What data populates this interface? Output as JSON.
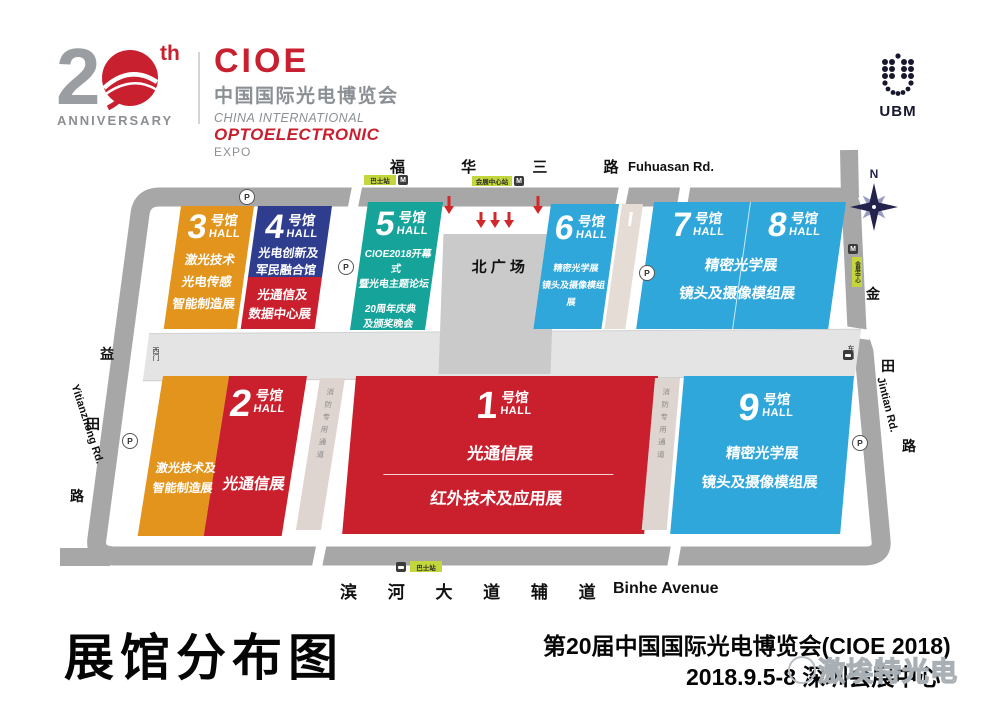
{
  "header": {
    "anniversary": {
      "number": "20",
      "suffix": "th",
      "label": "ANNIVERSARY"
    },
    "cioe": {
      "wordmark": "CIOE",
      "cn": "中国国际光电博览会",
      "en1": "CHINA INTERNATIONAL",
      "en2": "OPTOELECTRONIC",
      "en3": "EXPO"
    },
    "ubm": "UBM"
  },
  "map": {
    "compass_n": "N",
    "plaza": "北 广 场",
    "fire_lane": "消防专用通道",
    "gates": {
      "west": "西门",
      "east": "东门"
    },
    "roads": {
      "top_cn": "福 华 三 路",
      "top_en": "Fuhuasan Rd.",
      "left_cn": [
        "益",
        "田",
        "路"
      ],
      "left_en": "Yitianzhong Rd.",
      "right_cn": [
        "金",
        "田",
        "路"
      ],
      "right_en": "Jintian Rd.",
      "bottom_cn": "滨 河 大 道 辅 道",
      "bottom_en": "Binhe Avenue"
    },
    "badges": {
      "parking": "P",
      "metro": "M",
      "top_bus": "巴士站",
      "top_metro_station": "会展中心站",
      "right_station": "会展中心",
      "bottom_bus": "巴士站"
    },
    "halls": {
      "h3": {
        "num": "3",
        "cn": "号馆",
        "en": "HALL",
        "lines": [
          "激光技术",
          "光电传感",
          "智能制造展"
        ]
      },
      "h4": {
        "num": "4",
        "cn": "号馆",
        "en": "HALL",
        "top_lines": [
          "光电创新及",
          "军民融合馆"
        ],
        "bottom_lines": [
          "光通信及",
          "数据中心展"
        ]
      },
      "h5": {
        "num": "5",
        "cn": "号馆",
        "en": "HALL",
        "lines1": [
          "CIOE2018开幕式",
          "暨光电主题论坛"
        ],
        "lines2": [
          "20周年庆典",
          "及颁奖晚会"
        ]
      },
      "h6": {
        "num": "6",
        "cn": "号馆",
        "en": "HALL",
        "lines": [
          "精密光学展",
          "镜头及摄像模组展"
        ]
      },
      "h7": {
        "num": "7",
        "cn": "号馆",
        "en": "HALL"
      },
      "h8": {
        "num": "8",
        "cn": "号馆",
        "en": "HALL"
      },
      "h78_lines": [
        "精密光学展",
        "镜头及摄像模组展"
      ],
      "h2": {
        "num": "2",
        "cn": "号馆",
        "en": "HALL",
        "left_lines": [
          "激光技术及",
          "智能制造展"
        ],
        "right_line": "光通信展"
      },
      "h1": {
        "num": "1",
        "cn": "号馆",
        "en": "HALL",
        "line1": "光通信展",
        "line2": "红外技术及应用展"
      },
      "h9": {
        "num": "9",
        "cn": "号馆",
        "en": "HALL",
        "lines": [
          "精密光学展",
          "镜头及摄像模组展"
        ]
      }
    },
    "colors": {
      "orange": "#E2941C",
      "indigo": "#2F3D8F",
      "red": "#CA1F2D",
      "teal": "#15A39A",
      "blue": "#2FA7DB",
      "road_gray": "#A7A7A7",
      "corridor_gray": "#E4E4E4",
      "plaza_gray": "#CACACA",
      "fire_lane": "#DFD5D0",
      "badge_green": "#C3D63B"
    }
  },
  "footer": {
    "title": "展馆分布图",
    "event": "第20届中国国际光电博览会(CIOE 2018)",
    "date_venue": "2018.9.5-8 深圳会展中心",
    "watermark": "激埃特光电"
  }
}
